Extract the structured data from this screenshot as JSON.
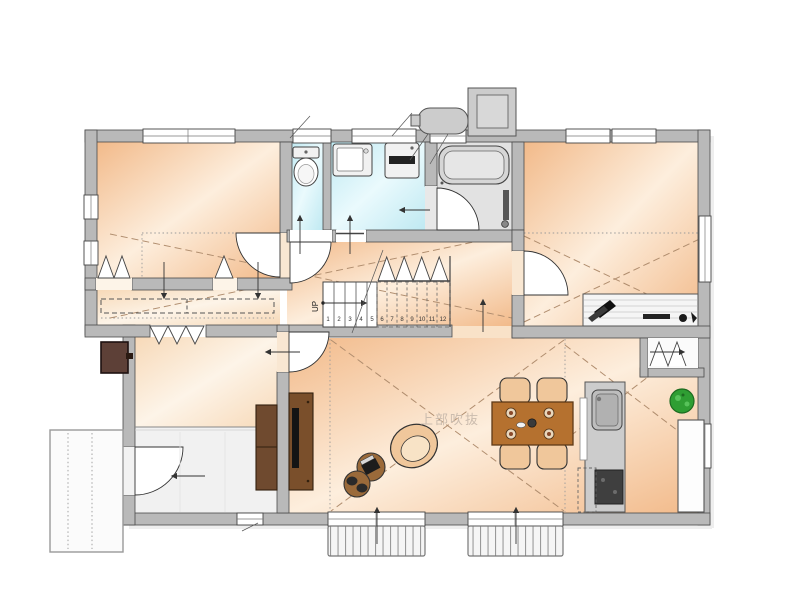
{
  "plan": {
    "stairs": {
      "up_label": "UP",
      "numbers": [
        "1",
        "2",
        "3",
        "4",
        "5",
        "6",
        "7",
        "8",
        "9",
        "10",
        "11",
        "12"
      ]
    },
    "annotations": {
      "atrium_label": "上部吹抜"
    },
    "icons": {
      "toilet": "toilet-fixture",
      "bathtub": "bathtub-fixture",
      "vanity": "vanity-sink",
      "washer": "washing-machine",
      "kitchen_sink": "kitchen-sink",
      "stove": "gas-stove",
      "plant": "potted-plant",
      "dining_set": "dining-table-4-chairs",
      "tv": "television",
      "water_heater": "water-heater-tank",
      "heat_pump": "heat-pump-unit"
    },
    "colors": {
      "wall_fill": "#b9b9b9",
      "wall_stroke": "#4a4a4a",
      "warm_edge": "#f2ba8a",
      "warm_center": "#fdeedd",
      "pale_edge": "#f7d9b8",
      "pale_center": "#fdf4e8",
      "wet_edge": "#bfe9f2",
      "wet_center": "#eafafd",
      "bath_floor": "#e2e2e2",
      "fixture_gray": "#cccccc",
      "stove_dark": "#3f3f3f",
      "table_wood": "#b5712f",
      "chair_wood": "#f0c79b",
      "cabinet_dark": "#6f4a2f",
      "tv_black": "#141414",
      "plant_green": "#2f9e33",
      "deck_fill": "#f5f5f5",
      "dash_line": "#b08d6e",
      "dot_line": "#9a9a9a",
      "label_gray": "#cbbcae"
    }
  }
}
